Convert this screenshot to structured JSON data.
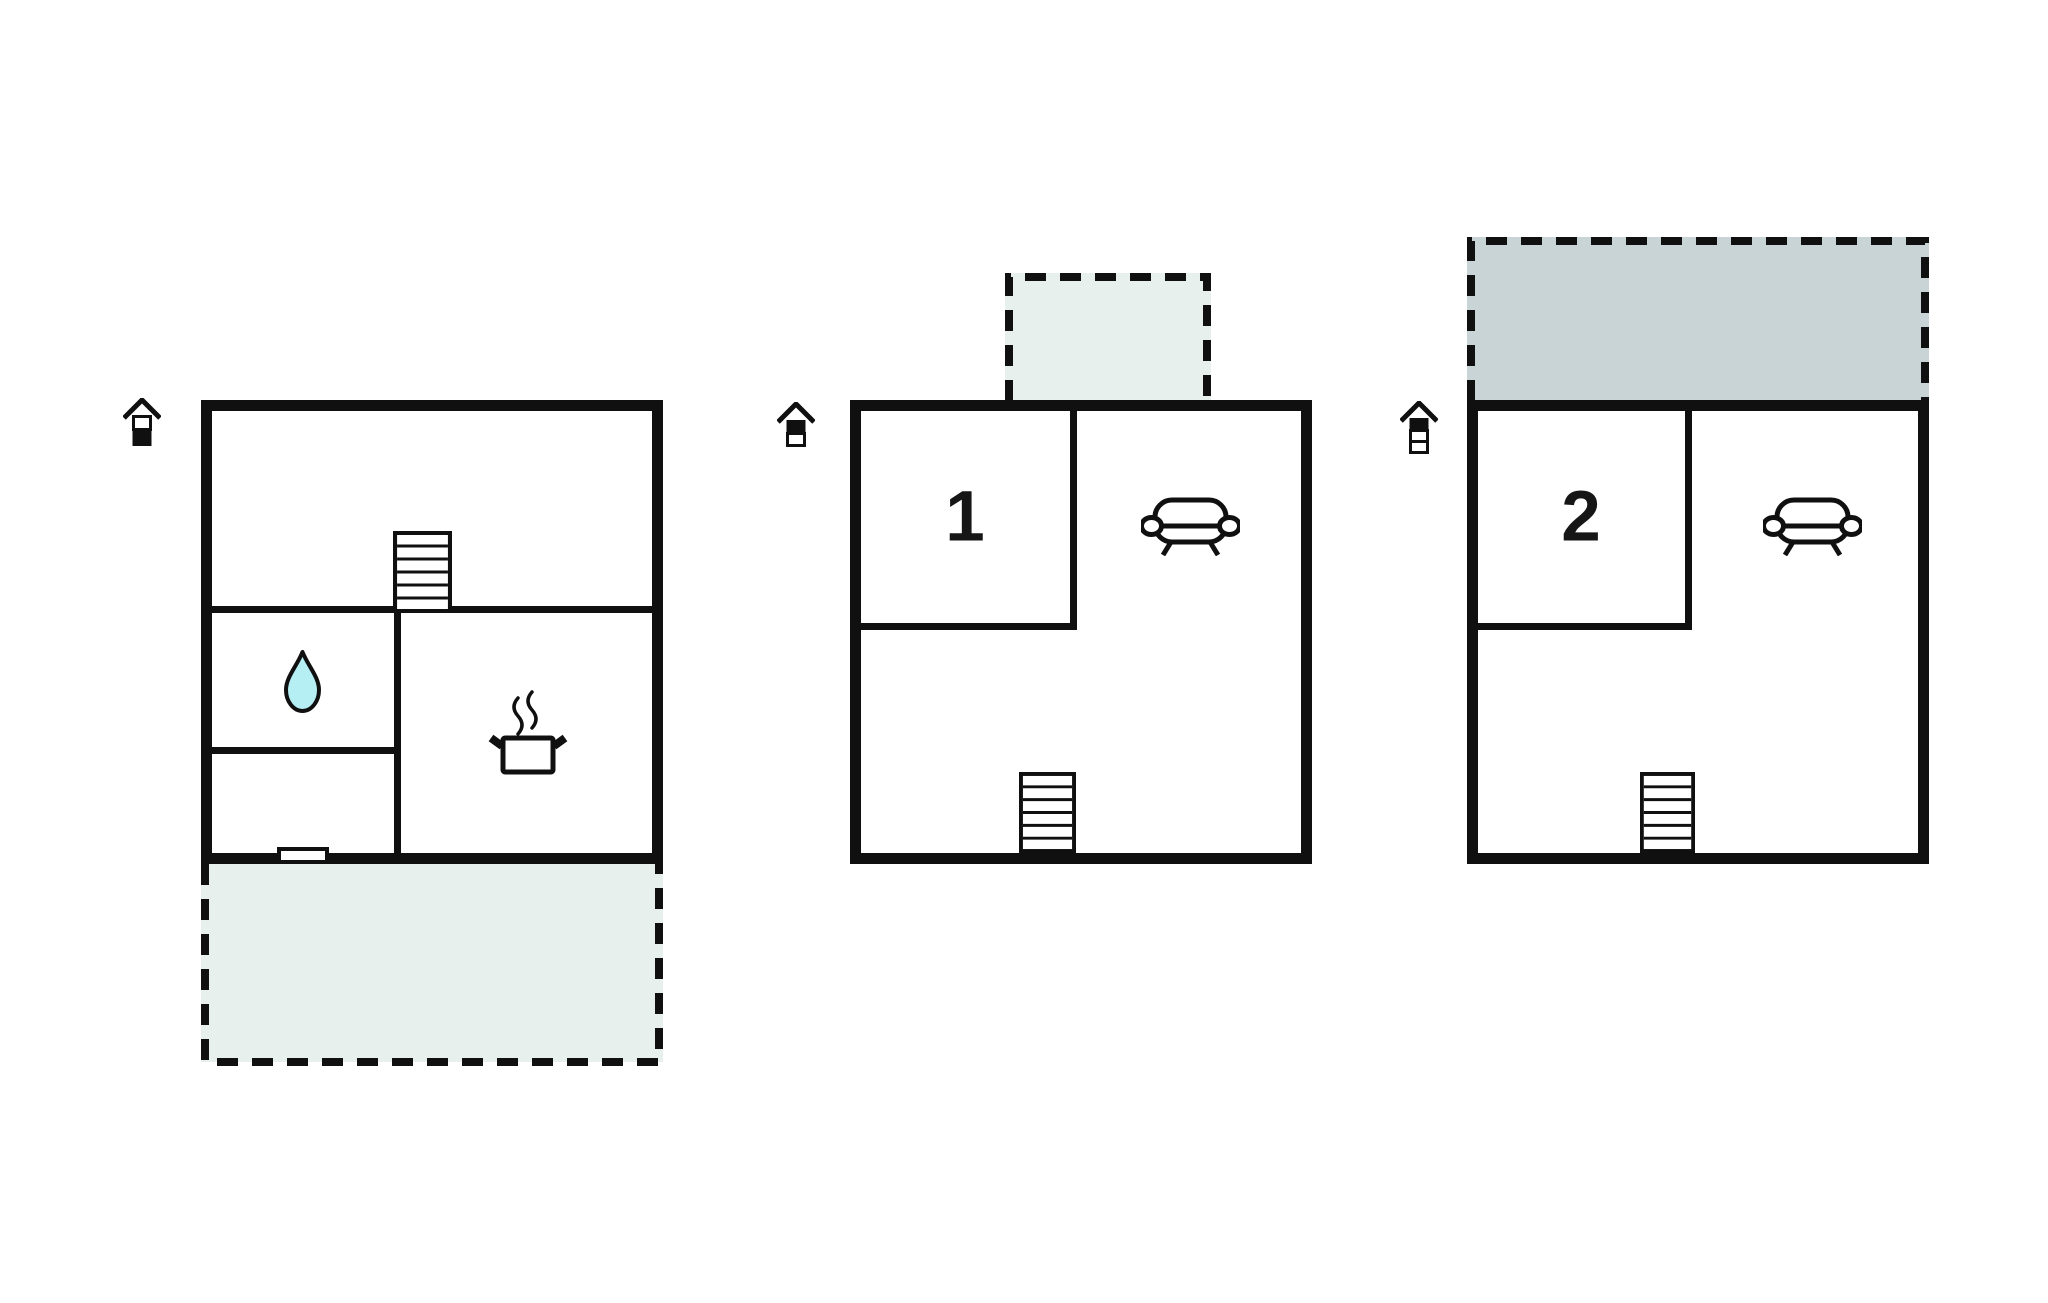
{
  "palette": {
    "wall_color": "#101010",
    "outdoor_light": "#e8f0ee",
    "outdoor_dark": "#c8d4d6",
    "water_drop": "#b5eff4",
    "background": "#ffffff"
  },
  "floors": [
    {
      "name": "ground-floor",
      "level_indicator_icon": "house-level-1-of-2-icon",
      "room_label": "",
      "features": [
        "stairs-icon",
        "water-drop-icon",
        "cooking-pot-icon",
        "entrance-door"
      ],
      "outdoor_area": {
        "type": "terrace",
        "position": "bottom",
        "shade": "light"
      }
    },
    {
      "name": "upper-floor-1",
      "level_indicator_icon": "house-level-2-of-2-icon",
      "room_label": "1",
      "features": [
        "sofa-icon",
        "stairs-icon"
      ],
      "outdoor_area": {
        "type": "balcony",
        "position": "top",
        "shade": "light"
      }
    },
    {
      "name": "upper-floor-2",
      "level_indicator_icon": "house-level-3-of-3-icon",
      "room_label": "2",
      "features": [
        "sofa-icon",
        "stairs-icon"
      ],
      "outdoor_area": {
        "type": "balcony",
        "position": "top",
        "shade": "dark"
      }
    }
  ]
}
